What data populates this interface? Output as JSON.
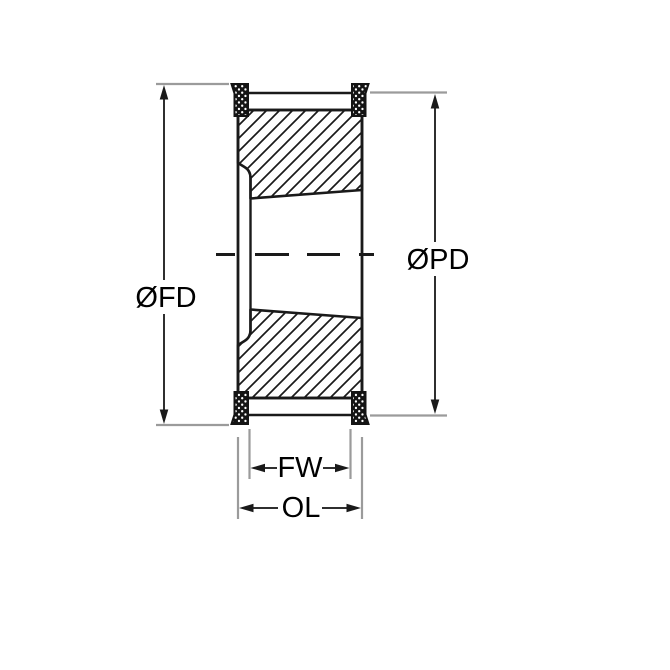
{
  "drawing": {
    "kind": "technical-drawing",
    "subject": "timing-pulley-flanged-cross-section",
    "labels": {
      "flange_diameter": "ØFD",
      "pitch_diameter": "ØPD",
      "face_width": "FW",
      "overall_length": "OL"
    },
    "colors": {
      "background": "#ffffff",
      "outline": "#1a1a1a",
      "hatch": "#1a1a1a",
      "knurl_fill": "#141414",
      "extension_line": "#9b9b9b",
      "dimension_line": "#2f2f2f",
      "label_text": "#000000"
    }
  }
}
